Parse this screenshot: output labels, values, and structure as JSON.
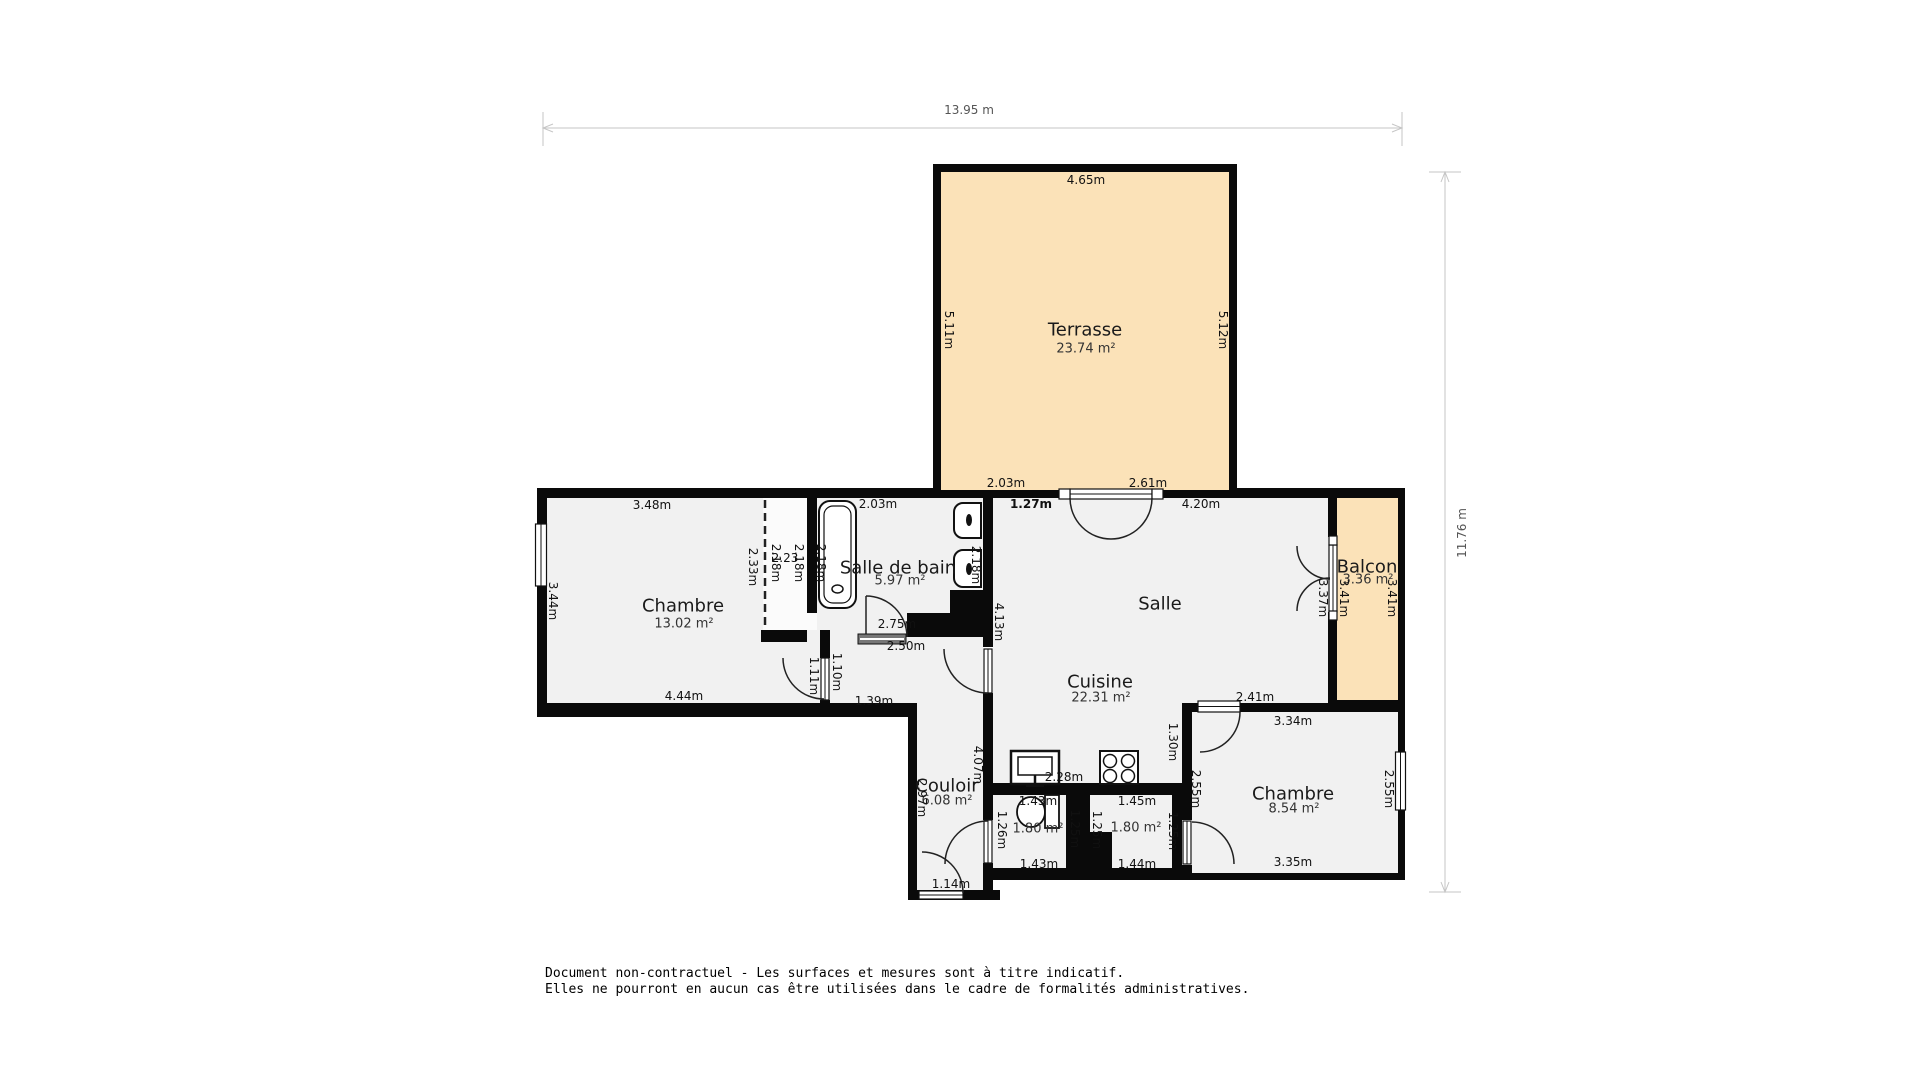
{
  "dim": {
    "w": "13.95 m",
    "h": "11.76 m"
  },
  "rooms": {
    "terrasse": {
      "name": "Terrasse",
      "area": "23.74 m²"
    },
    "chambre1": {
      "name": "Chambre",
      "area": "13.02 m²"
    },
    "sdb": {
      "name": "Salle de bain",
      "area": "5.97 m²"
    },
    "salle": {
      "name": "Salle"
    },
    "balcon": {
      "name": "Balcon",
      "area": "3.36 m²"
    },
    "cuisine": {
      "name": "Cuisine",
      "area": "22.31 m²"
    },
    "couloir": {
      "name": "Couloir",
      "area": "6.08 m²"
    },
    "chambre2": {
      "name": "Chambre",
      "area": "8.54 m²"
    },
    "wc1": {
      "area": "1.80 m²"
    },
    "wc2": {
      "area": "1.80 m²"
    }
  },
  "measurements": [
    "3.48m",
    "3.44m",
    "4.44m",
    "2.33m",
    "2.18m",
    "2.23",
    "2.18m",
    "2.18m",
    "2.03m",
    "2.75m",
    "2.50m",
    "1.39m",
    "1.11m",
    "1.10m",
    "2.97m",
    "4.07m",
    "1.14m",
    "1.26m",
    "4.13m",
    "2.18m",
    "2.03m",
    "2.61m",
    "1.27m",
    "4.20m",
    "4.65m",
    "5.11m",
    "5.12m",
    "3.37m",
    "3.41m",
    "3.41m",
    "2.41m",
    "3.34m",
    "3.35m",
    "2.55m",
    "2.55m",
    "1.30m",
    "1.25m",
    "2.28m",
    "1.43m",
    "1.43m",
    "1.45m",
    "1.44m",
    "1.25m",
    "1.25m"
  ],
  "disclaimer": {
    "line1": "Document non-contractuel - Les surfaces et mesures sont à titre indicatif.",
    "line2": "Elles ne pourront en aucun cas être utilisées dans le cadre de formalités administratives."
  },
  "colors": {
    "wall": "#0a0a0a",
    "floor": "#f1f1f1",
    "outdoor": "#fbe2b8",
    "dim_line": "#c6c6c6"
  }
}
